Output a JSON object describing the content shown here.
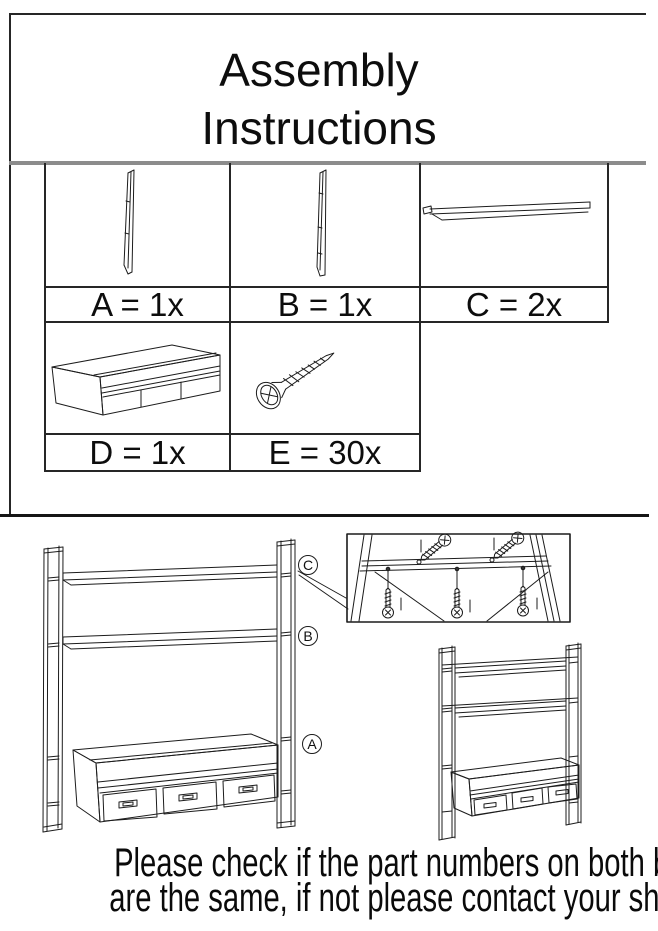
{
  "title": {
    "line1": "Assembly",
    "line2": "Instructions"
  },
  "parts_table": {
    "items": [
      {
        "letter": "A",
        "label": "A = 1x",
        "icon": "side-panel-a-icon"
      },
      {
        "letter": "B",
        "label": "B = 1x",
        "icon": "side-panel-b-icon"
      },
      {
        "letter": "C",
        "label": "C = 2x",
        "icon": "shelf-plank-icon"
      },
      {
        "letter": "D",
        "label": "D = 1x",
        "icon": "drawer-cabinet-icon"
      },
      {
        "letter": "E",
        "label": "E = 30x",
        "icon": "screw-icon"
      }
    ]
  },
  "diagram": {
    "callouts": [
      {
        "letter": "C"
      },
      {
        "letter": "B"
      },
      {
        "letter": "A"
      }
    ]
  },
  "footer": {
    "line1": "Please check if the part numbers on both boxes",
    "line2": "are the same, if not please contact your shop."
  },
  "colors": {
    "paper": "#ffffff",
    "ink": "#111111",
    "divider_gray": "#8c8c8c"
  }
}
